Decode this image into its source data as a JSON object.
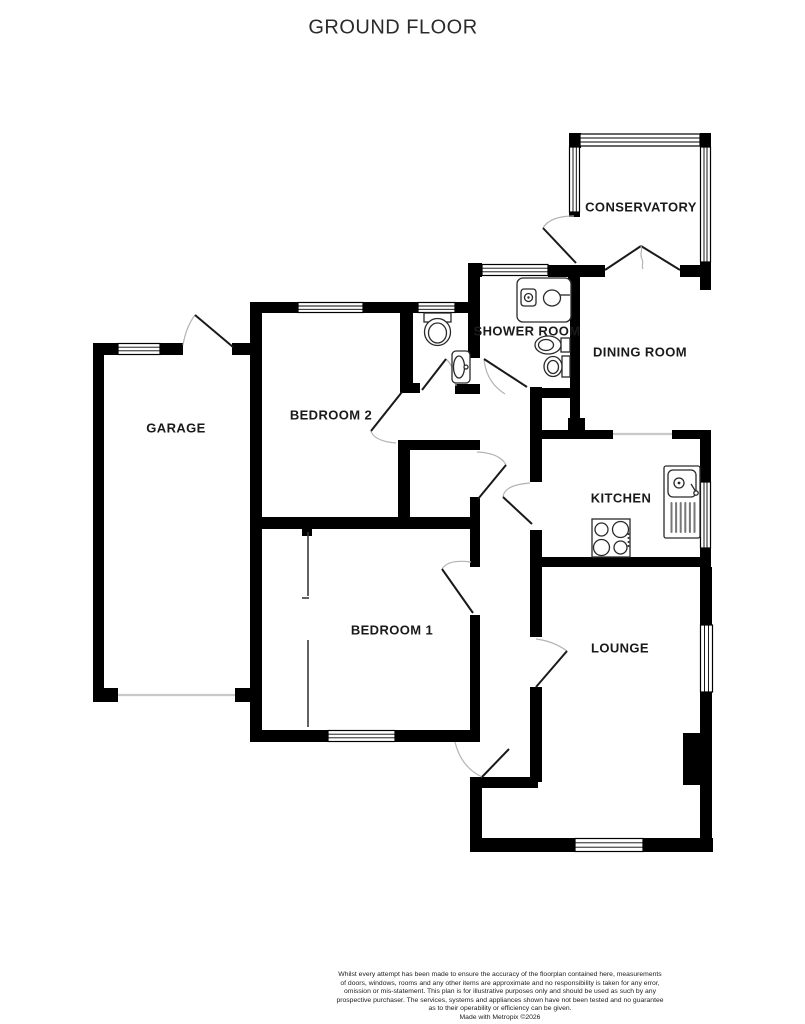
{
  "title": "GROUND FLOOR",
  "rooms": [
    {
      "name": "conservatory",
      "label": "CONSERVATORY"
    },
    {
      "name": "dining-room",
      "label": "DINING ROOM"
    },
    {
      "name": "shower-room",
      "label": "SHOWER ROOM"
    },
    {
      "name": "kitchen",
      "label": "KITCHEN"
    },
    {
      "name": "garage",
      "label": "GARAGE"
    },
    {
      "name": "bedroom-2",
      "label": "BEDROOM 2"
    },
    {
      "name": "bedroom-1",
      "label": "BEDROOM 1"
    },
    {
      "name": "lounge",
      "label": "LOUNGE"
    }
  ],
  "fixtures": [
    "shower-enclosure",
    "pedestal-basin",
    "toilet",
    "wc-toilet",
    "wc-basin",
    "kitchen-sink-drainer",
    "hob",
    "built-in-wardrobe",
    "chimney-breast",
    "garage-door",
    "french-doors",
    "front-door"
  ],
  "colors": {
    "wall": "#000000",
    "door_arc": "#b3b3b3",
    "text": "#1a1a1a"
  },
  "footer": {
    "lines": [
      "Whilst every attempt has been made to ensure the accuracy of the floorplan contained here, measurements",
      "of doors, windows, rooms and any other items are approximate and no responsibility is taken for any error,",
      "omission or mis-statement. This plan is for illustrative purposes only and should be used as such by any",
      "prospective purchaser. The services, systems and appliances shown have not been tested and no guarantee",
      "as to their operability or efficiency can be given.",
      "Made with Metropix ©2026"
    ]
  }
}
